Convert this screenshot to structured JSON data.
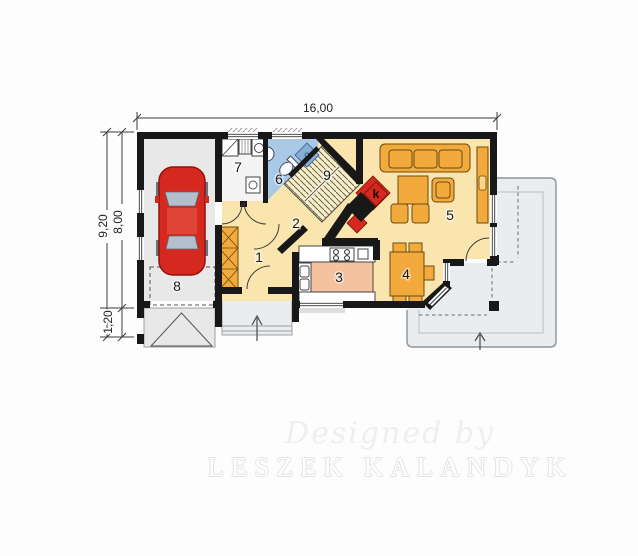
{
  "plan": {
    "title": "single-storey house floor plan",
    "dimensions": {
      "width_label": "16,00",
      "total_height_label": "9,20",
      "main_height_label": "8,00",
      "porch_height_label": "1,20"
    },
    "rooms": {
      "r1": "1",
      "r2": "2",
      "r3": "3",
      "r4": "4",
      "r5": "5",
      "r6": "6",
      "r7": "7",
      "r8": "8",
      "r9": "9"
    },
    "fireplace_label": "k"
  },
  "watermark": {
    "line1": "Designed by",
    "line2": "LESZEK KALANDYK"
  },
  "colors": {
    "wall": "#181818",
    "floor_yellow": "#fbe5ae",
    "floor_gray": "#e8e8e8",
    "floor_white": "#f4f4f4",
    "floor_blue": "#a9c9e6",
    "floor_stairs": "#f8eec8",
    "terrace": "#e9edf0",
    "furniture": "#f2aa3c",
    "island": "#f4c29f",
    "car": "#d5281e",
    "fireplace": "#d5281e"
  }
}
